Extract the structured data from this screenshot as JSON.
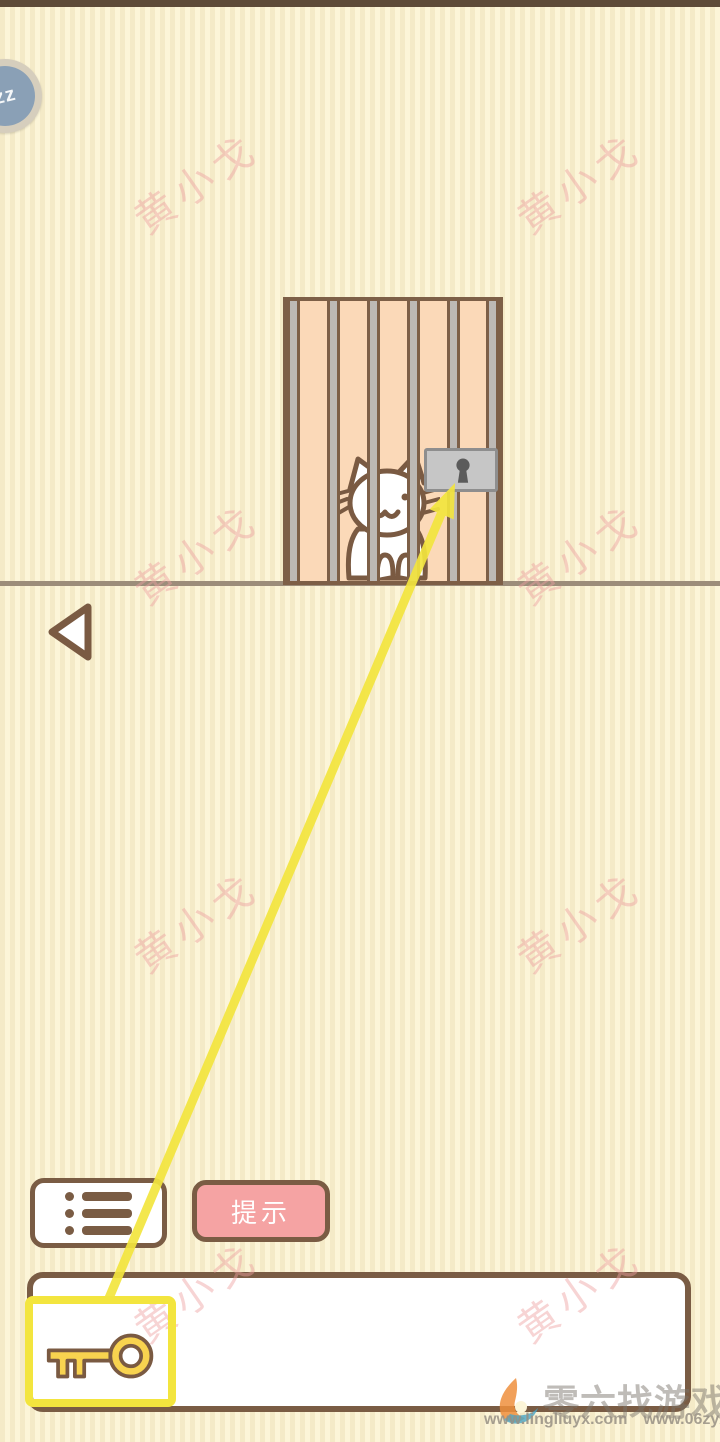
{
  "hud": {
    "badge_label": "zz"
  },
  "overlay": {
    "watermark_text": "黄小戈",
    "watermark_color": "rgba(238,160,160,0.45)",
    "arrow_color": "#f3e53e",
    "positions": [
      [
        195,
        181
      ],
      [
        578,
        181
      ],
      [
        195,
        552
      ],
      [
        578,
        552
      ],
      [
        195,
        920
      ],
      [
        578,
        920
      ],
      [
        195,
        1290
      ],
      [
        578,
        1290
      ]
    ]
  },
  "scene": {
    "cat": "white-cat-behind-bars",
    "lock": "gray-padlock",
    "cage_color": "#fbd9b8",
    "bar_color": "#bdb9b5",
    "outline_color": "#7a5c44"
  },
  "controls": {
    "hint_label": "提示",
    "menu_icon": "list-icon",
    "back_icon": "back-triangle-icon"
  },
  "inventory": {
    "items": [
      {
        "name": "key",
        "selected": true,
        "icon": "key-icon",
        "highlight_color": "#f3e53e"
      }
    ]
  },
  "footer": {
    "site_name": "零六找游戏",
    "url_left": "www.lingliuyx.com",
    "url_right": "www.06zyx.com",
    "logo": "flame-six-logo"
  }
}
